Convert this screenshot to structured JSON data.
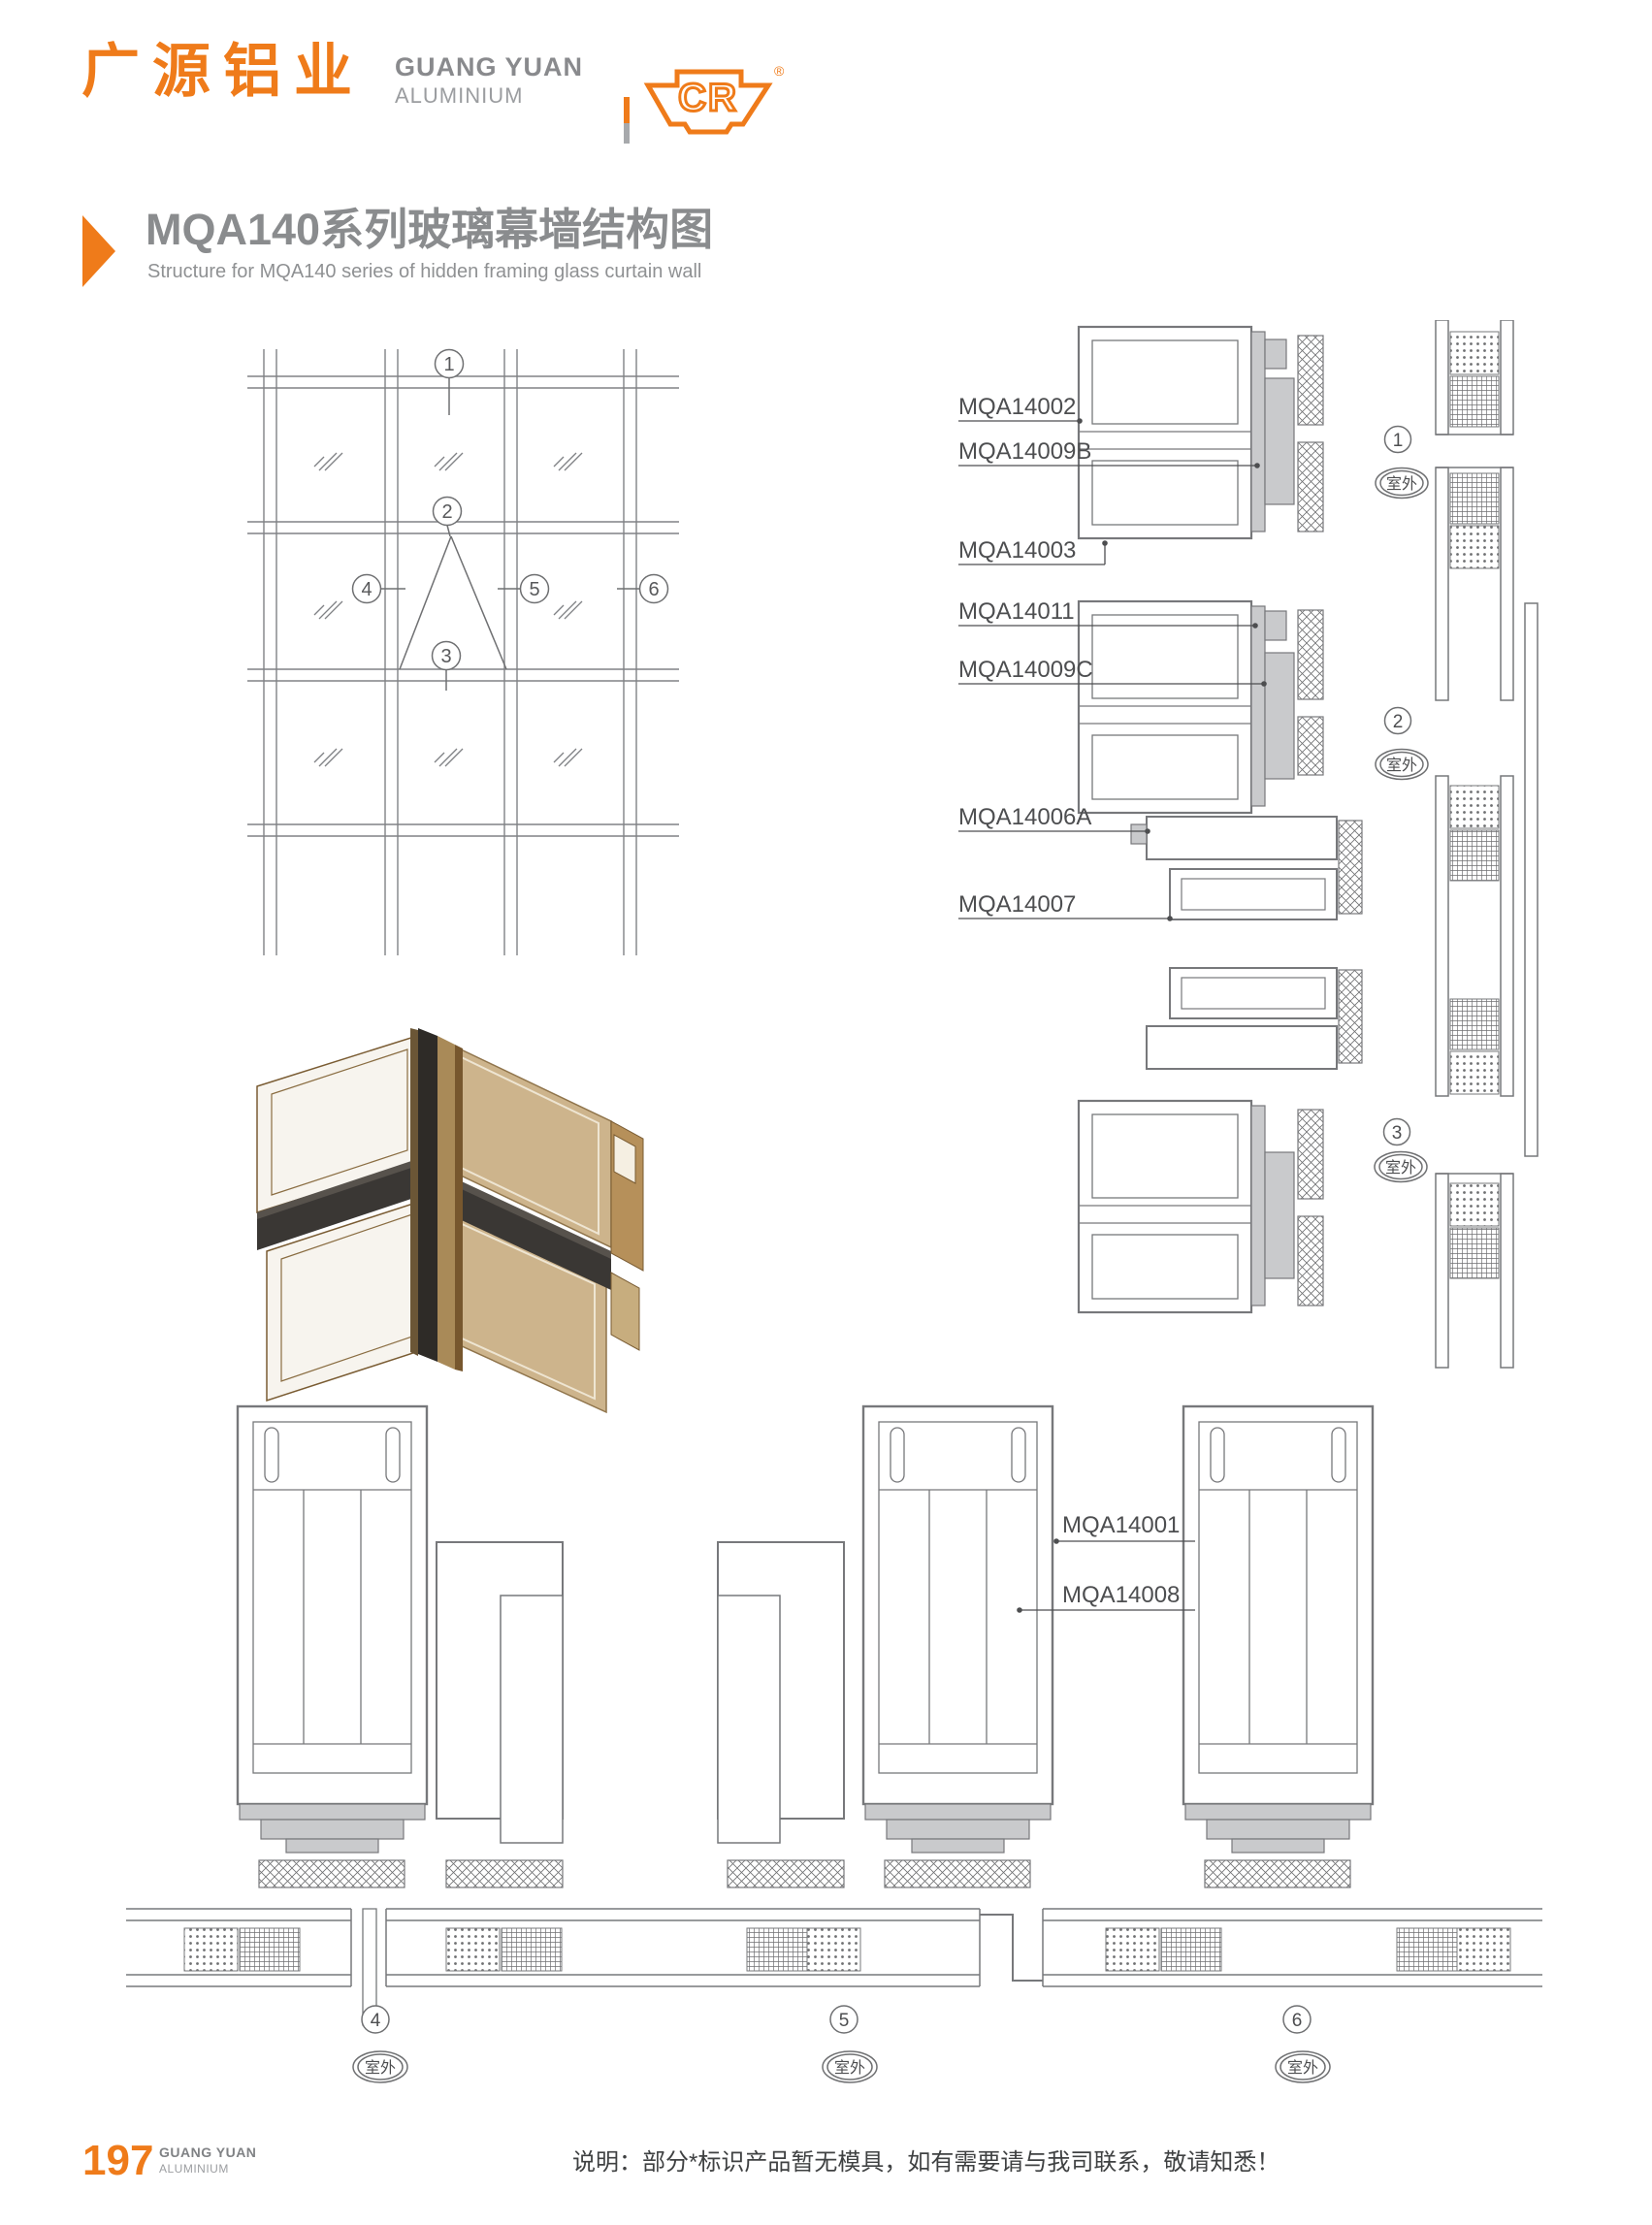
{
  "header": {
    "logo_cn": "广源铝业",
    "logo_en1": "GUANG YUAN",
    "logo_en2": "ALUMINIUM",
    "cr": "CR",
    "reg": "®"
  },
  "title": {
    "cn": "MQA140系列玻璃幕墙结构图",
    "en": "Structure for MQA140 series of hidden framing glass curtain wall"
  },
  "elevation": {
    "c1": "1",
    "c2": "2",
    "c3": "3",
    "c4": "4",
    "c5": "5",
    "c6": "6"
  },
  "right_sections": {
    "l1": "MQA14002",
    "l2": "MQA14009B",
    "l3": "MQA14003",
    "l4": "MQA14011",
    "l5": "MQA14009C",
    "l6": "MQA14006A",
    "l7": "MQA14007",
    "c1": "1",
    "c2": "2",
    "c3": "3",
    "outdoor": "室外"
  },
  "bottom_sections": {
    "l1": "MQA14001",
    "l2": "MQA14008",
    "c4": "4",
    "c5": "5",
    "c6": "6",
    "outdoor": "室外"
  },
  "footer": {
    "page": "197",
    "brand1": "GUANG YUAN",
    "brand2": "ALUMINIUM",
    "note": "说明：部分*标识产品暂无模具，如有需要请与我司联系，敬请知悉！"
  },
  "colors": {
    "accent": "#ef7b1a",
    "title_gray": "#8a8c8e",
    "line_gray": "#77787b",
    "fill_gray": "#c9cacc",
    "text_dark": "#4d4e50"
  }
}
